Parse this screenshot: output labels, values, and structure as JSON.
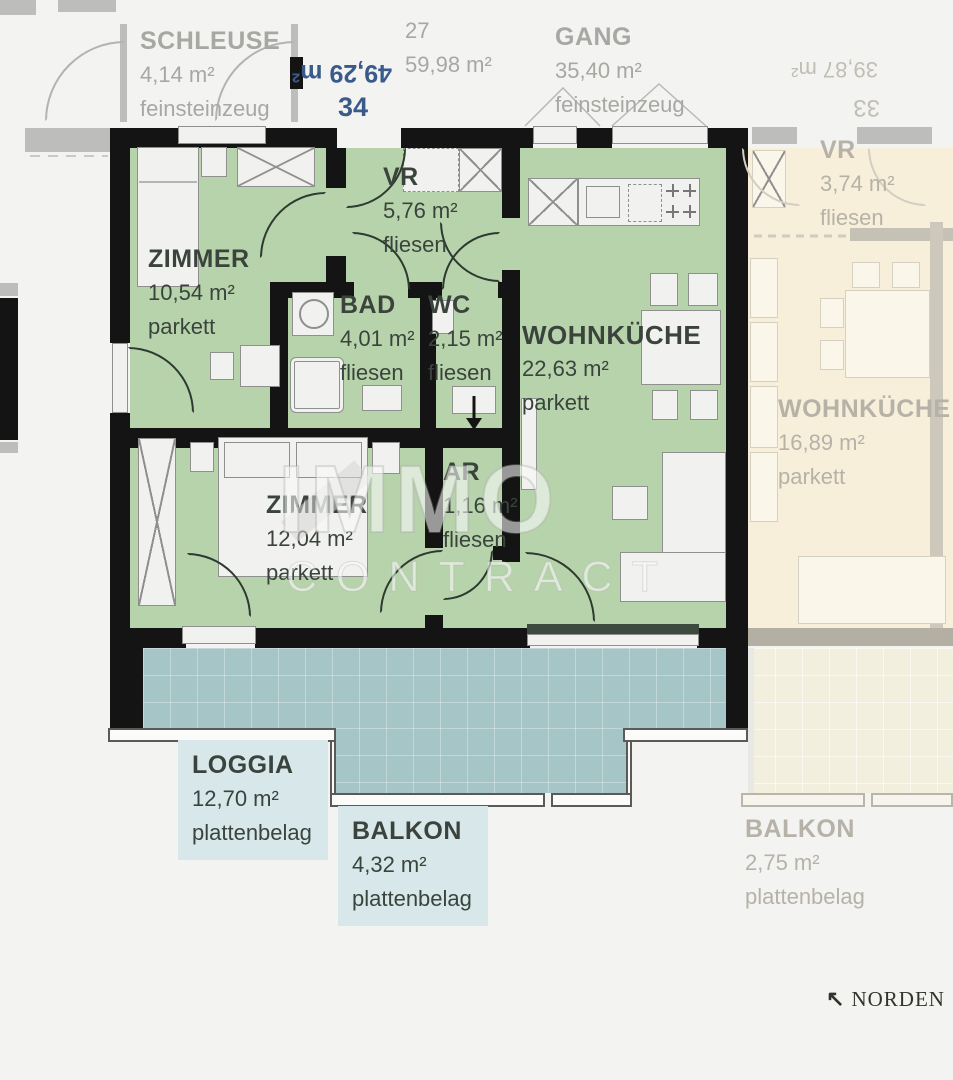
{
  "corridor": {
    "schleuse": {
      "name": "SCHLEUSE",
      "area": "4,14 m²",
      "floor": "feinsteinzeug"
    },
    "unit27": {
      "id": "27",
      "area": "59,98 m²"
    },
    "gang": {
      "name": "GANG",
      "area": "35,40 m²",
      "floor": "feinsteinzeug"
    }
  },
  "apartment": {
    "number": "34",
    "area_rotated": "49,29 m²",
    "rooms": {
      "zimmer1": {
        "name": "ZIMMER",
        "area": "10,54 m²",
        "floor": "parkett"
      },
      "vr": {
        "name": "VR",
        "area": "5,76 m²",
        "floor": "fliesen"
      },
      "bad": {
        "name": "BAD",
        "area": "4,01 m²",
        "floor": "fliesen"
      },
      "wc": {
        "name": "WC",
        "area": "2,15 m²",
        "floor": "fliesen"
      },
      "wohnkueche": {
        "name": "WOHNKÜCHE",
        "area": "22,63 m²",
        "floor": "parkett"
      },
      "zimmer2": {
        "name": "ZIMMER",
        "area": "12,04 m²",
        "floor": "parkett"
      },
      "ar": {
        "name": "AR",
        "area": "1,16 m²",
        "floor": "fliesen"
      },
      "loggia": {
        "name": "LOGGIA",
        "area": "12,70 m²",
        "floor": "plattenbelag"
      },
      "balkon": {
        "name": "BALKON",
        "area": "4,32 m²",
        "floor": "plattenbelag"
      }
    }
  },
  "neighbor": {
    "number_rotated": "33",
    "area_rotated": "39,87 m²",
    "rooms": {
      "vr": {
        "name": "VR",
        "area": "3,74 m²",
        "floor": "fliesen"
      },
      "wohnkueche": {
        "name": "WOHNKÜCHE",
        "area": "16,89 m²",
        "floor": "parkett"
      },
      "balkon": {
        "name": "BALKON",
        "area": "2,75 m²",
        "floor": "plattenbelag"
      }
    }
  },
  "watermark": {
    "line1": "IMMO",
    "line2": "CONTRACT"
  },
  "compass": {
    "arrow": "↖",
    "label": "NORDEN"
  },
  "colors": {
    "room_green": "#b7d3ab",
    "loggia_teal": "#a6c5c7",
    "neighbor_cream": "#f7efda",
    "wall": "#141414",
    "unit_number_blue": "#3a5a8c",
    "label_dark": "#3a443c",
    "corridor_gray": "#a7a7a4",
    "label_bg_blue": "#d7e7ea"
  }
}
